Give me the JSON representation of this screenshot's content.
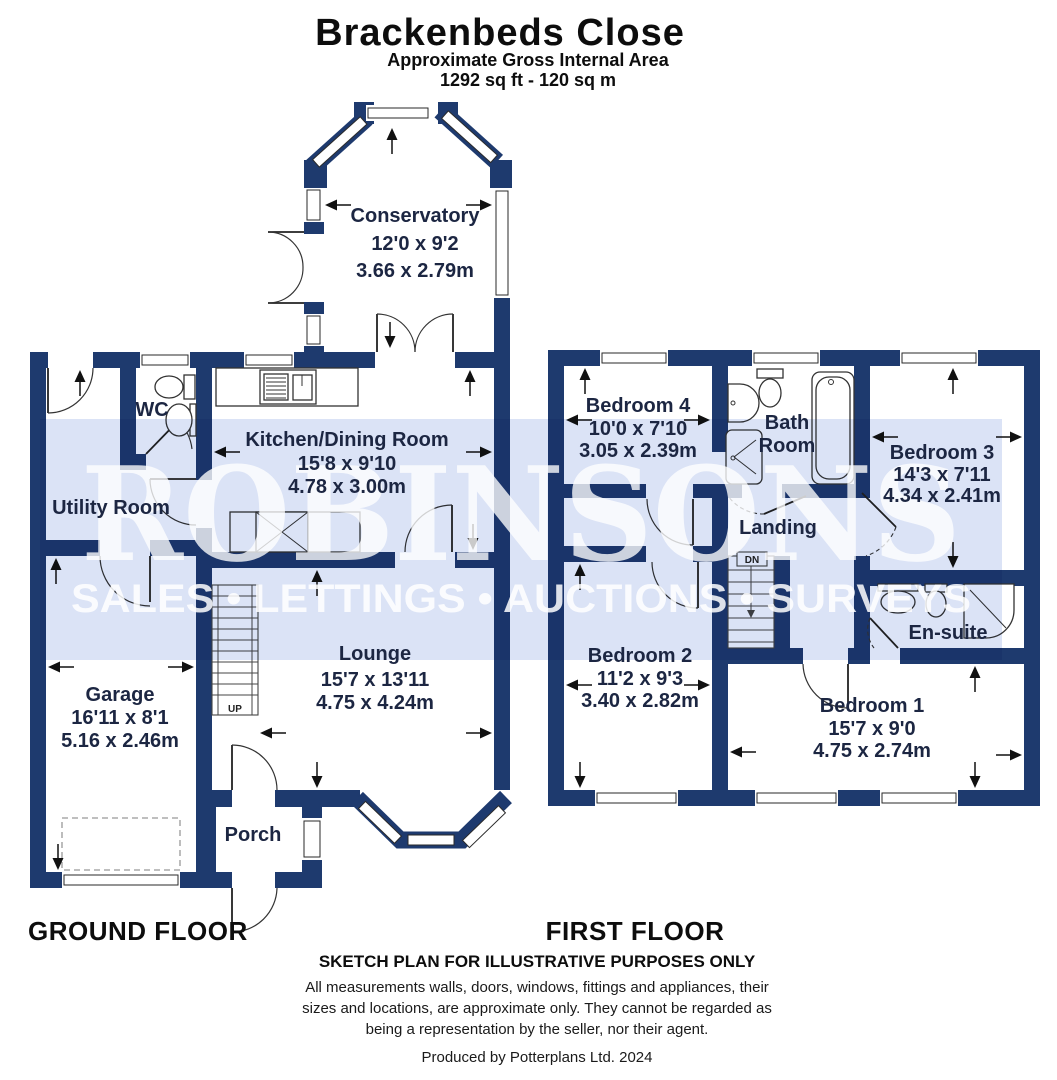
{
  "header": {
    "title": "Brackenbeds Close",
    "subtitle": "Approximate Gross Internal Area",
    "area": "1292 sq ft - 120 sq m"
  },
  "watermark": {
    "brand": "ROBINSONS",
    "tagline": "SALES • LETTINGS • AUCTIONS • SURVEYS"
  },
  "ground_floor": {
    "label": "GROUND FLOOR",
    "conservatory": {
      "name": "Conservatory",
      "imperial": "12'0 x 9'2",
      "metric": "3.66 x 2.79m"
    },
    "wc": {
      "name": "WC"
    },
    "kitchen": {
      "name": "Kitchen/Dining Room",
      "imperial": "15'8 x 9'10",
      "metric": "4.78 x 3.00m"
    },
    "utility": {
      "name": "Utility Room"
    },
    "lounge": {
      "name": "Lounge",
      "imperial": "15'7 x 13'11",
      "metric": "4.75 x 4.24m"
    },
    "garage": {
      "name": "Garage",
      "imperial": "16'11 x 8'1",
      "metric": "5.16 x 2.46m"
    },
    "porch": {
      "name": "Porch"
    },
    "stairs_label": "UP"
  },
  "first_floor": {
    "label": "FIRST FLOOR",
    "bedroom4": {
      "name": "Bedroom 4",
      "imperial": "10'0 x 7'10",
      "metric": "3.05 x 2.39m"
    },
    "bathroom": {
      "line1": "Bath",
      "line2": "Room"
    },
    "bedroom3": {
      "name": "Bedroom 3",
      "imperial": "14'3 x 7'11",
      "metric": "4.34 x 2.41m"
    },
    "landing": {
      "name": "Landing"
    },
    "bedroom2": {
      "name": "Bedroom 2",
      "imperial": "11'2 x 9'3",
      "metric": "3.40 x 2.82m"
    },
    "ensuite": {
      "name": "En-suite"
    },
    "bedroom1": {
      "name": "Bedroom 1",
      "imperial": "15'7 x 9'0",
      "metric": "4.75 x 2.74m"
    },
    "stairs_label": "DN"
  },
  "footer": {
    "disclaimer_title": "SKETCH PLAN FOR ILLUSTRATIVE PURPOSES ONLY",
    "disclaimer_line1": "All measurements walls, doors, windows, fittings and appliances, their",
    "disclaimer_line2": "sizes and locations, are approximate only. They cannot be regarded as",
    "disclaimer_line3": "being a representation by the seller, nor their agent.",
    "credit": "Produced by Potterplans Ltd. 2024"
  },
  "colors": {
    "wall": "#1e3a6e",
    "watermark_band": "#dbe3f6",
    "room_text": "#1c2642"
  }
}
